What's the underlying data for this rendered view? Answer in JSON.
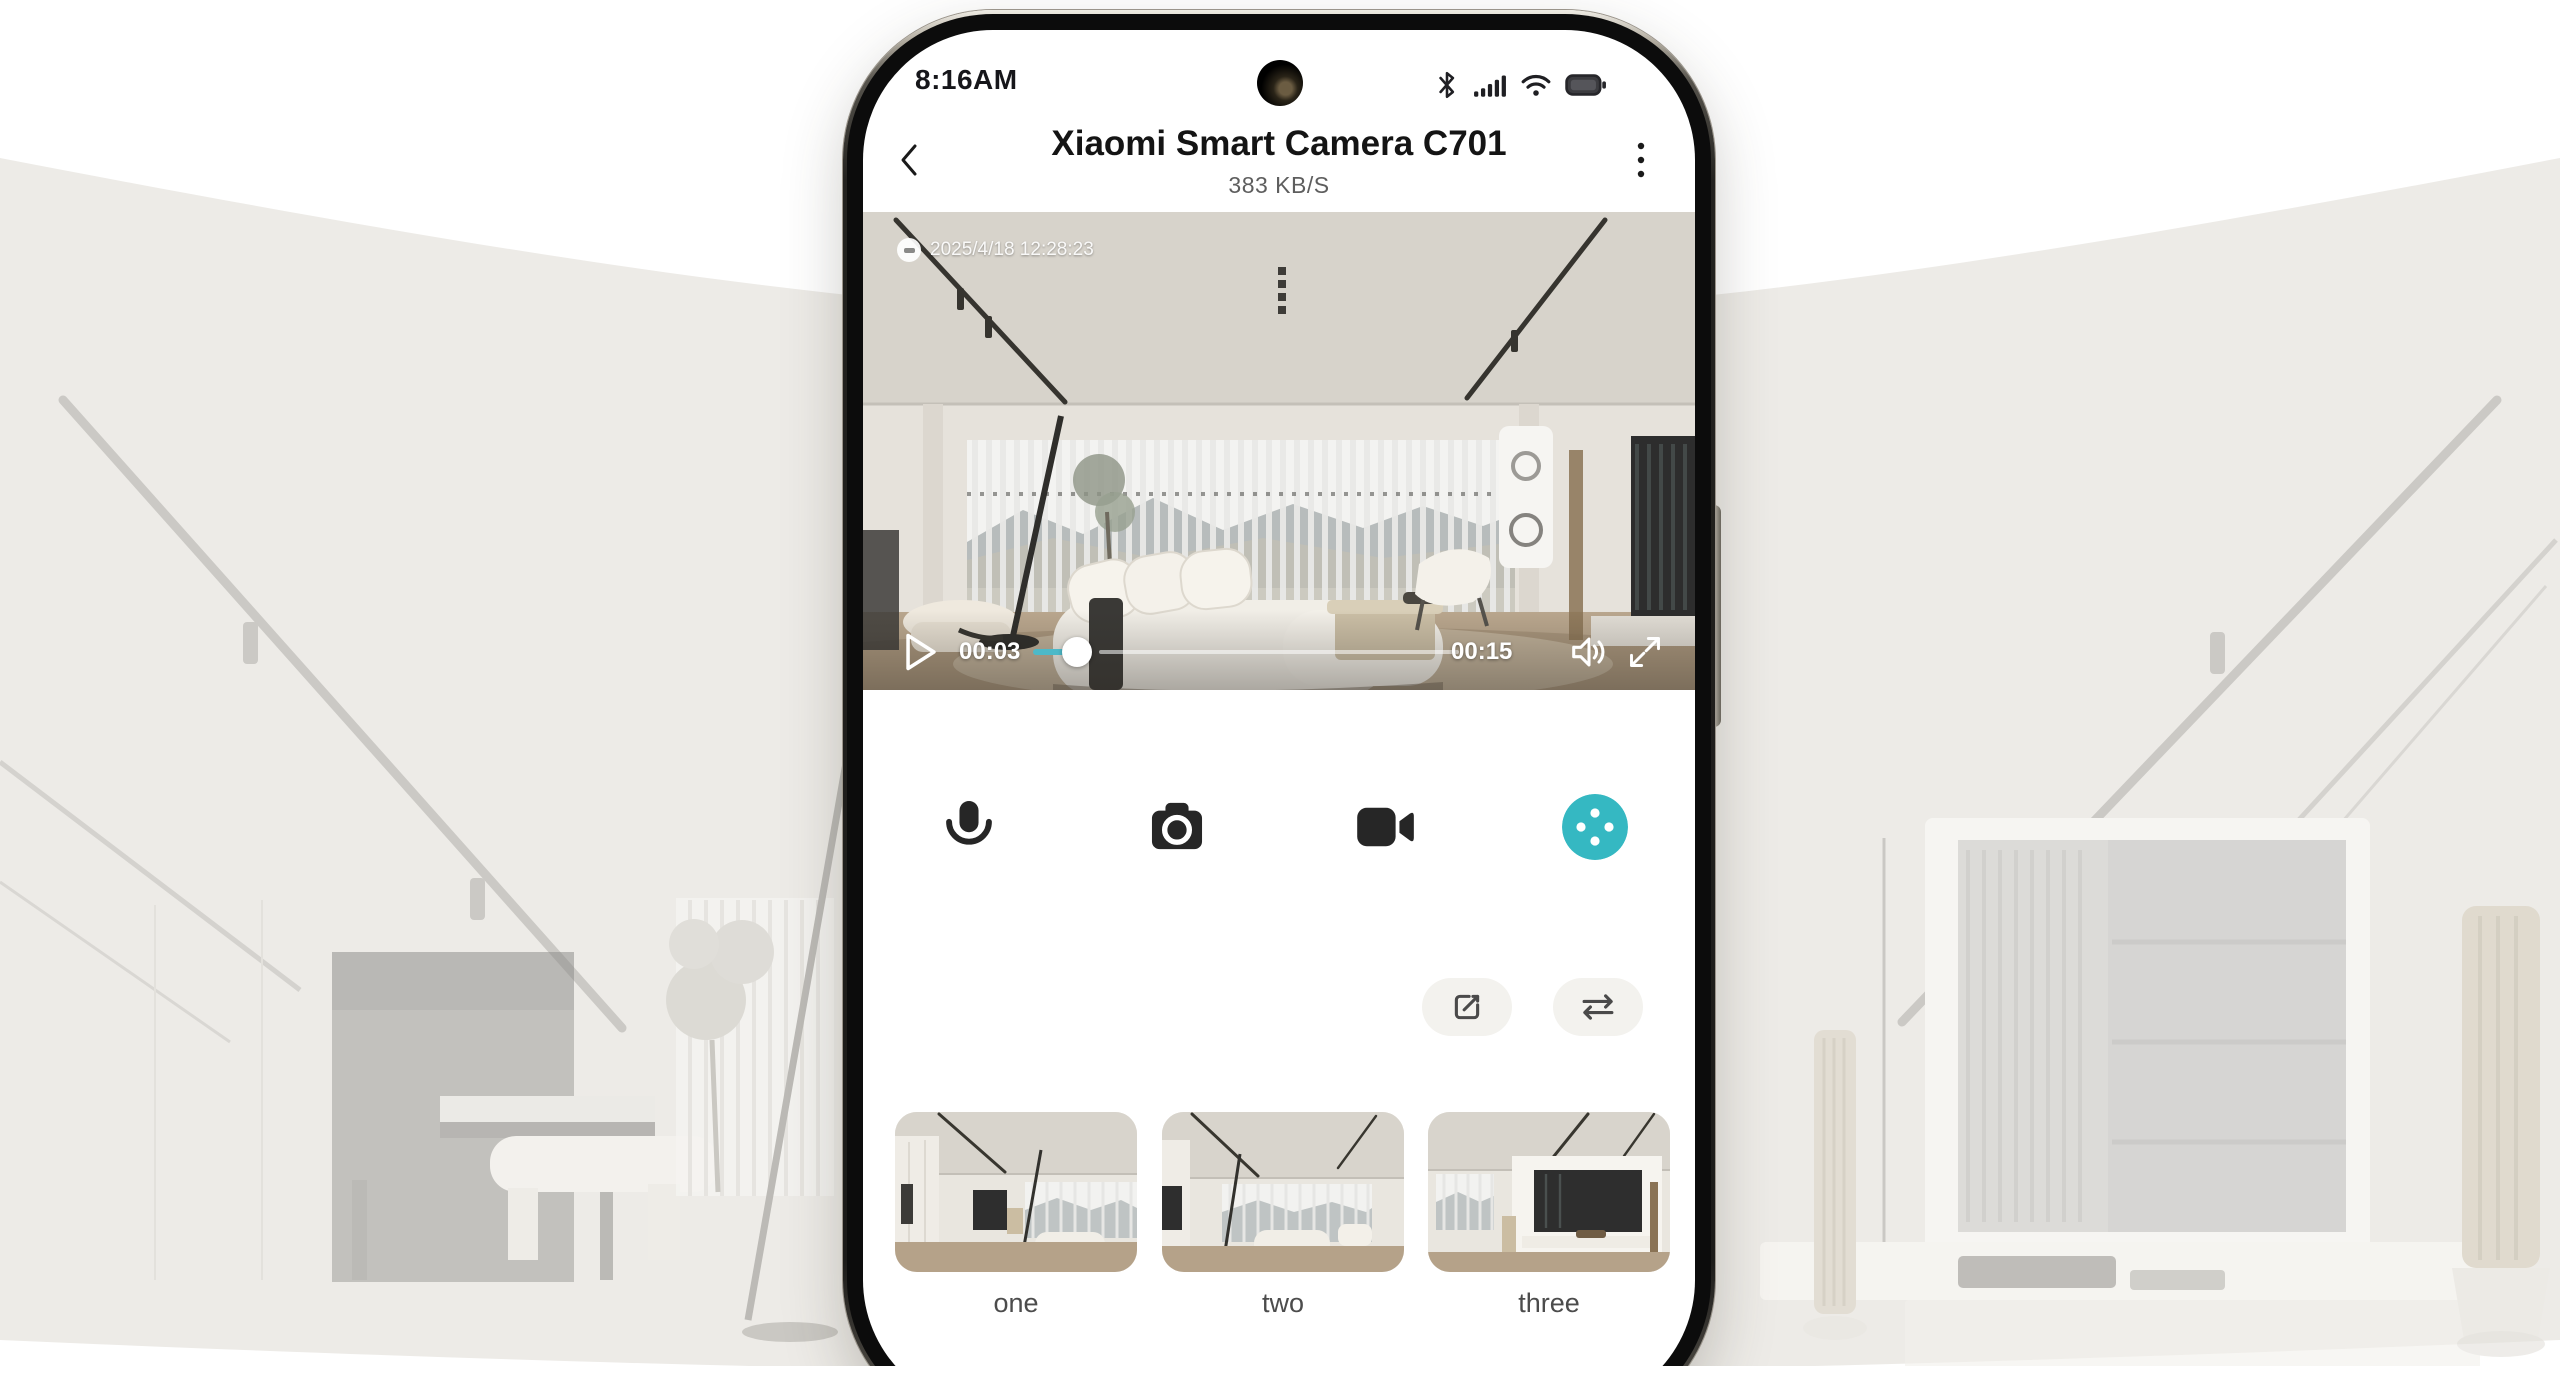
{
  "status_bar": {
    "time": "8:16AM",
    "icons": [
      "bluetooth-icon",
      "signal-icon",
      "wifi-icon",
      "battery-icon"
    ]
  },
  "header": {
    "title": "Xiaomi Smart Camera C701",
    "subtitle": "383 KB/S",
    "back_icon": "chevron-left",
    "menu_icon": "kebab-vertical"
  },
  "video": {
    "timestamp": "2025/4/18 12:28:23",
    "elapsed": "00:03",
    "duration": "00:15",
    "overlay_icons": [
      "play-icon",
      "scrubber-knob",
      "volume-icon",
      "fullscreen-icon"
    ]
  },
  "tools": {
    "icons": [
      "microphone-icon",
      "photo-camera-icon",
      "video-camera-icon",
      "ptz-dpad-icon"
    ]
  },
  "actions": {
    "icons": [
      "edit-icon",
      "swap-icon"
    ]
  },
  "thumbnails": [
    {
      "label": "one"
    },
    {
      "label": "two"
    },
    {
      "label": "three"
    }
  ],
  "colors": {
    "accent_teal": "#35b8c2",
    "progress_teal": "#4db9c8",
    "screen_bg": "#ffffff",
    "hero_bg": "#edebe7"
  }
}
